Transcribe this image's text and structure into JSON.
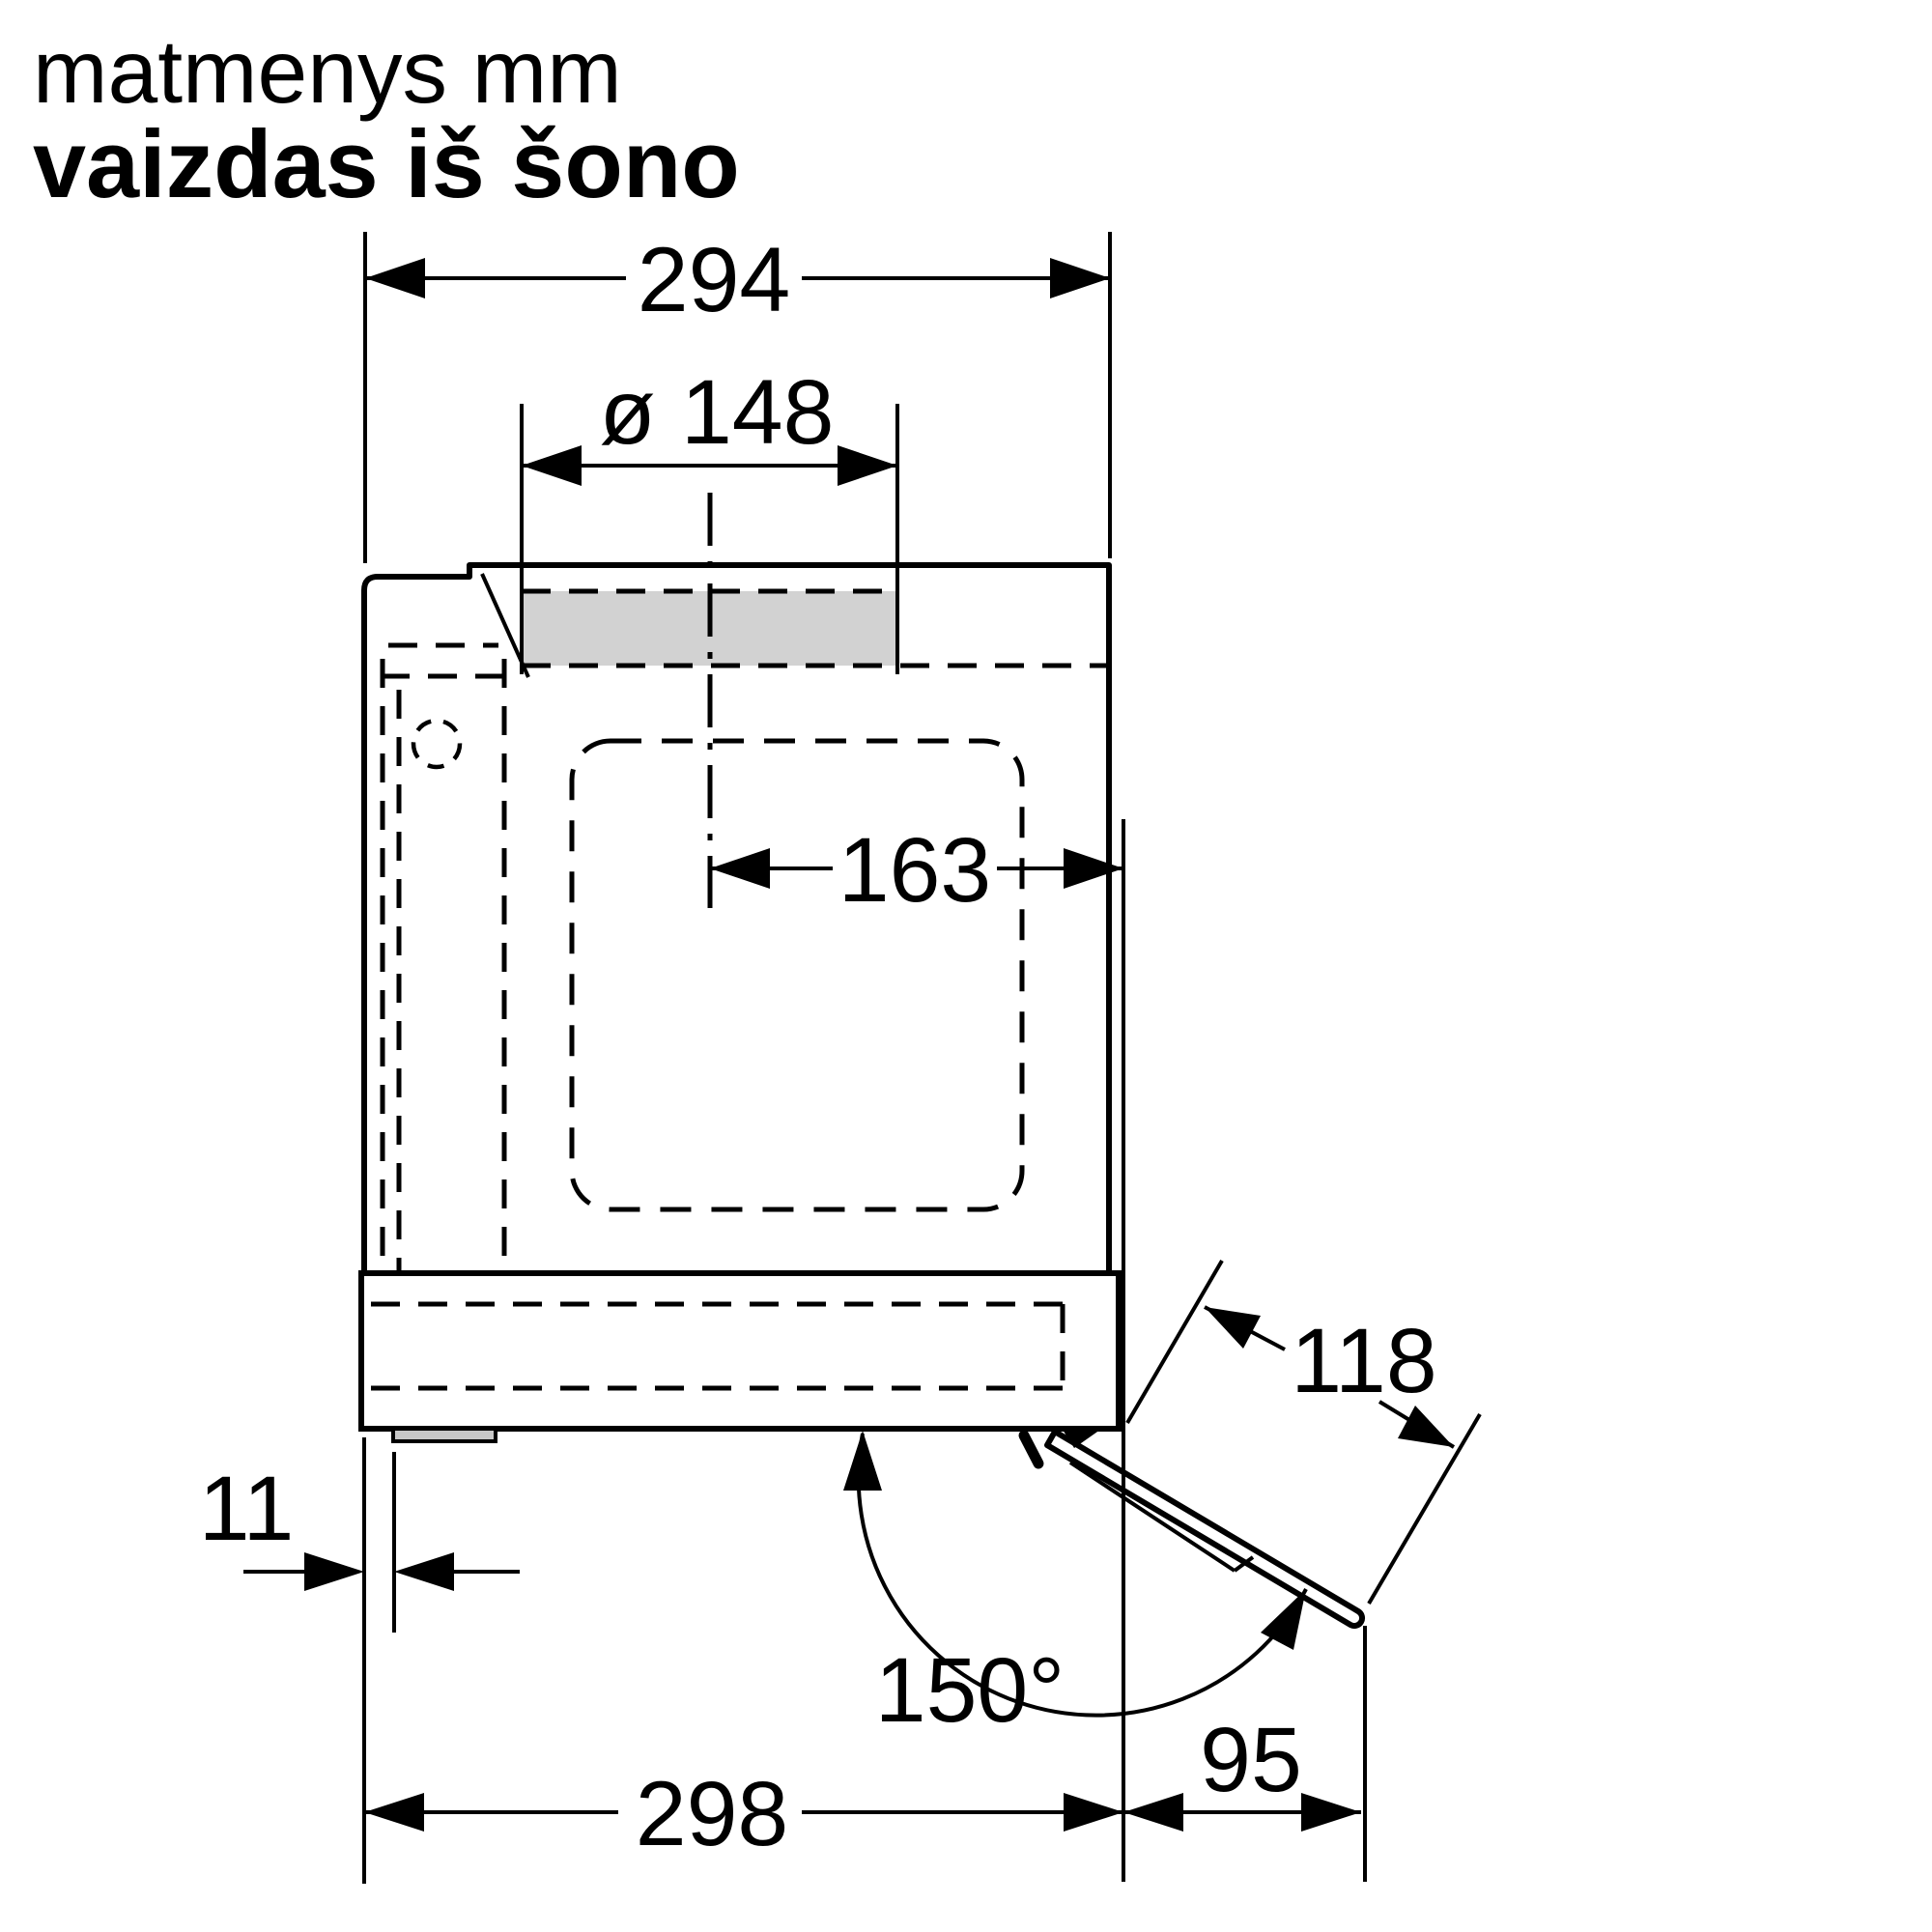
{
  "title": {
    "line1": "matmenys mm",
    "line2": "vaizdas iš šono"
  },
  "dimensions": {
    "top_width": "294",
    "duct_diameter": "ø 148",
    "center_to_back": "163",
    "visor_length": "118",
    "front_offset": "11",
    "opening_angle": "150°",
    "bottom_depth": "298",
    "visor_projection": "95"
  },
  "colors": {
    "line": "#000000",
    "background": "#ffffff",
    "vent_fill": "#d2d2d2",
    "foot_fill": "#c8c8c8"
  }
}
